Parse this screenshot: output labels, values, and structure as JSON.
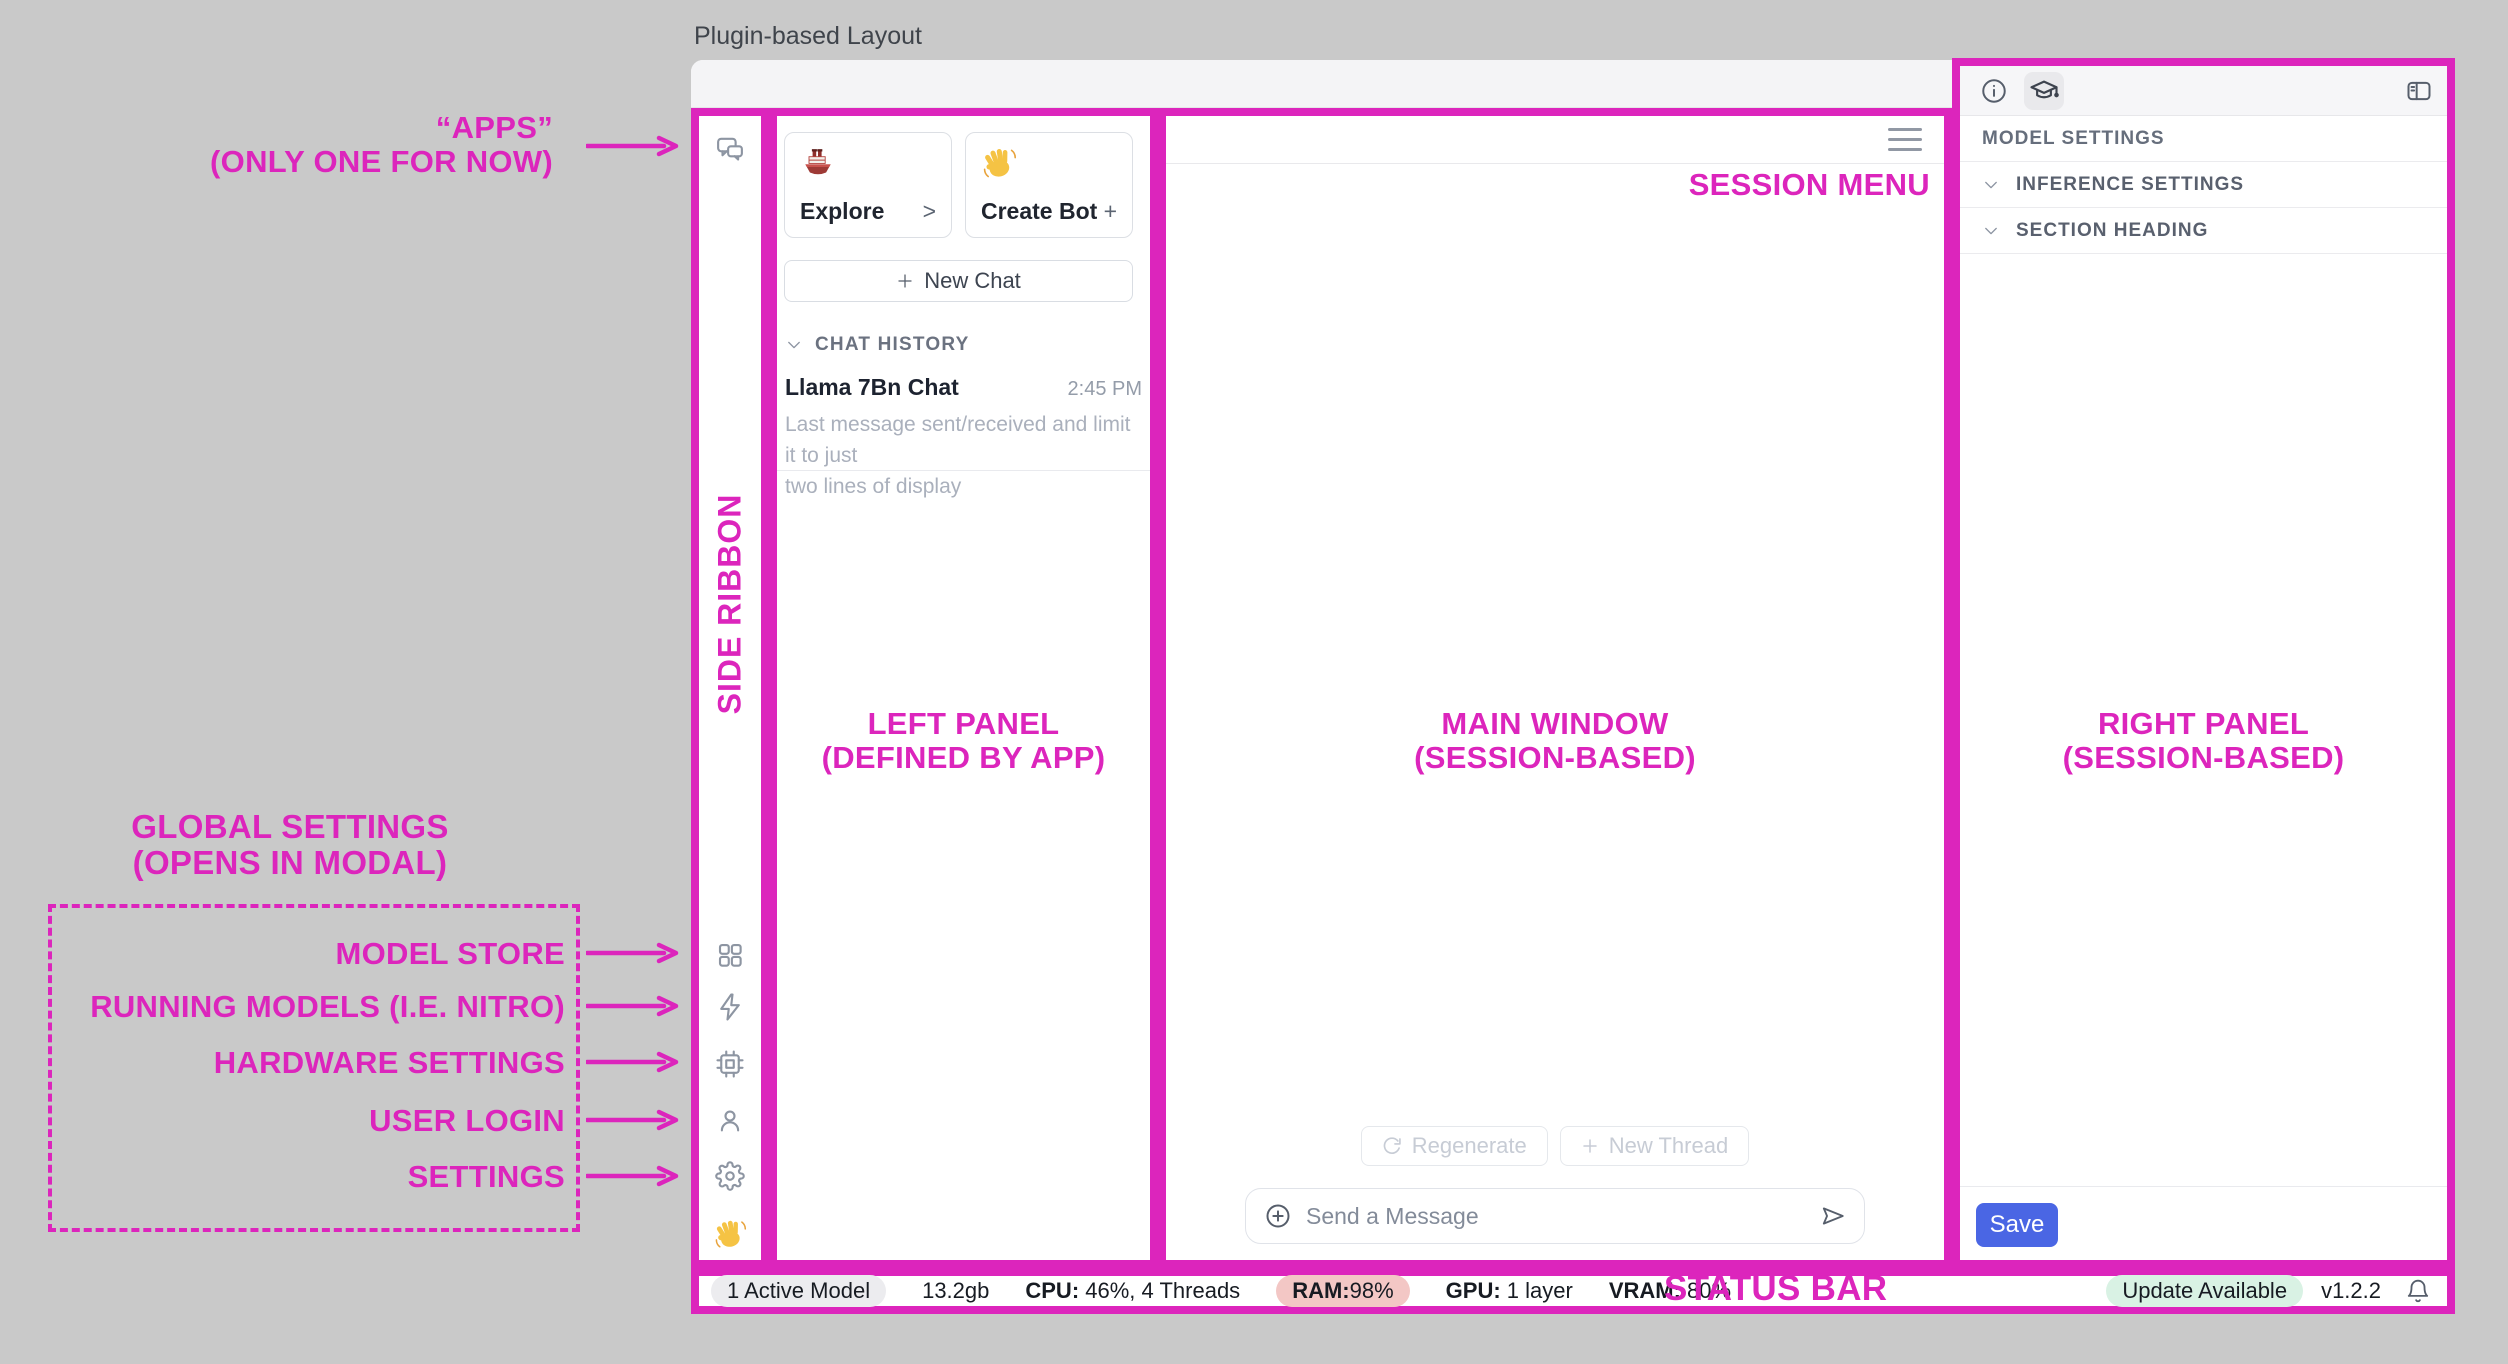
{
  "annotation": {
    "color": "#DC25BC",
    "title": "Plugin-based Layout",
    "apps_line1": "“APPS”",
    "apps_line2": "(ONLY ONE FOR NOW)",
    "side_ribbon": "SIDE RIBBON",
    "left_panel_line1": "LEFT PANEL",
    "left_panel_line2": "(DEFINED BY APP)",
    "main_window_line1": "MAIN WINDOW",
    "main_window_line2": "(SESSION-BASED)",
    "session_menu": "SESSION MENU",
    "right_panel_line1": "RIGHT PANEL",
    "right_panel_line2": "(SESSION-BASED)",
    "status_bar": "STATUS BAR",
    "global_heading_line1": "GLOBAL SETTINGS",
    "global_heading_line2": "(OPENS IN MODAL)",
    "global_items": [
      "MODEL STORE",
      "RUNNING MODELS (I.E. NITRO)",
      "HARDWARE SETTINGS",
      "USER LOGIN",
      "SETTINGS"
    ]
  },
  "left_panel": {
    "explore_card": {
      "label": "Explore",
      "action": ">"
    },
    "create_bot_card": {
      "label": "Create Bot",
      "action": "+"
    },
    "new_chat_label": "New Chat",
    "chat_history_header": "CHAT HISTORY",
    "chat_item": {
      "title": "Llama 7Bn Chat",
      "time": "2:45 PM",
      "preview_line1": "Last message sent/received and limit it to just",
      "preview_line2": "two lines of display"
    }
  },
  "main": {
    "regenerate_label": "Regenerate",
    "new_thread_label": "New Thread",
    "message_placeholder": "Send a Message"
  },
  "right_panel": {
    "model_settings_label": "MODEL SETTINGS",
    "inference_settings_label": "INFERENCE SETTINGS",
    "section_heading_label": "SECTION HEADING",
    "save_label": "Save"
  },
  "status_bar": {
    "active_model": "1 Active Model",
    "size": "13.2gb",
    "cpu_label": "CPU:",
    "cpu_value": " 46%, 4 Threads",
    "ram_label": "RAM:",
    "ram_value": " 98%",
    "gpu_label": "GPU:",
    "gpu_value": " 1 layer",
    "vram_label": "VRAM:",
    "vram_value": " 80%",
    "update_badge": "Update Available",
    "version": "v1.2.2"
  },
  "icons": [
    "chat",
    "grid",
    "zap",
    "cpu",
    "user",
    "gear",
    "wave-hand",
    "ship",
    "info",
    "graduation-cap",
    "panel-toggle",
    "hamburger",
    "chevron-down",
    "plus",
    "refresh",
    "plus-circle",
    "send",
    "bell",
    "traffic-lights"
  ]
}
